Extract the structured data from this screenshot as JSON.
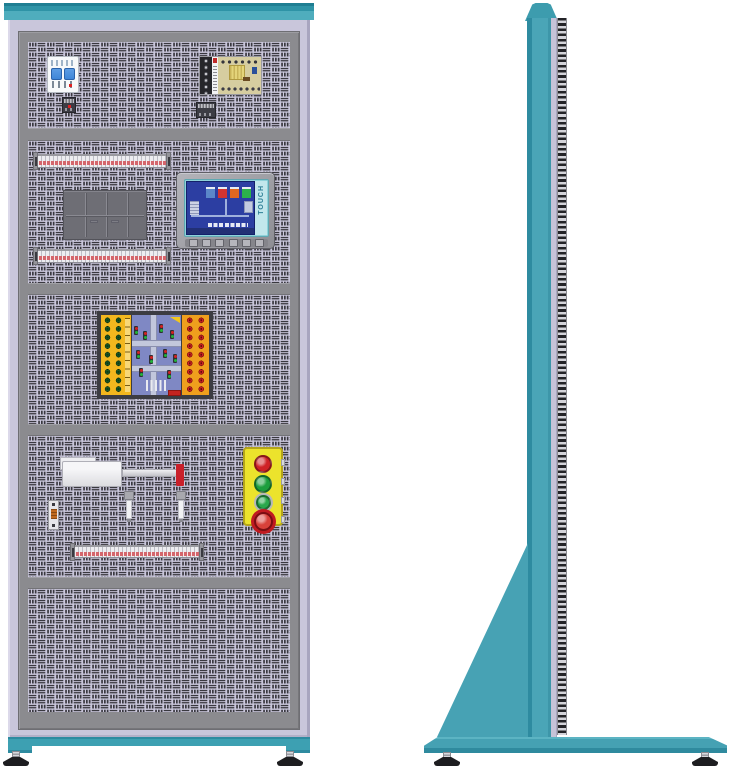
{
  "title": "Electrical automation training cabinet — front view and side view",
  "colors": {
    "cabinet_teal": "#4aa5b7",
    "cabinet_teal_dark": "#2e8ba0",
    "frame_lavender": "#c9c6db",
    "panel_gray": "#8b8b8f",
    "perforation_dark": "#39383f",
    "station_yellow": "#ece32c",
    "board_yellow": "#f3b71e",
    "board_orange": "#ef9f1d",
    "board_blue": "#7f88c4",
    "hmi_screen_blue": "#2c3ea2",
    "terminal_strip_red": "#d4666c",
    "breaker_toggle_blue": "#3f86d8",
    "cylinder_tip_red": "#c9202a"
  },
  "hmi": {
    "touch_label": "TOUCH",
    "function_key_count": 6,
    "screen_indicators": [
      "#5b87c9",
      "#d23430",
      "#e0671f",
      "#2cb24b"
    ]
  },
  "pushbutton_station": {
    "buttons": [
      {
        "type": "red-pushbutton",
        "color": "#cf2127",
        "y": 6,
        "size": 18
      },
      {
        "type": "green-pushbutton",
        "color": "#1d9e3e",
        "y": 26,
        "size": 18
      },
      {
        "type": "green-pushbutton-small",
        "color": "#2aa84c",
        "y": 46,
        "size": 15
      },
      {
        "type": "emergency-stop-button",
        "color": "#d8413a",
        "y": 63,
        "size": 19
      }
    ]
  },
  "traffic_board": {
    "left_sockets": {
      "rows": 9,
      "cols": 2,
      "color": "#1c5c28"
    },
    "right_sockets": {
      "rows": 9,
      "cols": 2,
      "color": "#cf2222"
    },
    "signals": [
      {
        "x": 134,
        "y": 326
      },
      {
        "x": 143,
        "y": 331
      },
      {
        "x": 159,
        "y": 324
      },
      {
        "x": 170,
        "y": 330
      },
      {
        "x": 136,
        "y": 350
      },
      {
        "x": 149,
        "y": 355
      },
      {
        "x": 163,
        "y": 349
      },
      {
        "x": 173,
        "y": 354
      },
      {
        "x": 139,
        "y": 368
      },
      {
        "x": 167,
        "y": 370
      }
    ]
  },
  "components": {
    "front": [
      "circuit-breaker",
      "power-supply",
      "terminal-strip",
      "plc-module-block",
      "hmi-touch-panel",
      "terminal-strip",
      "traffic-light-training-board",
      "pneumatic-cylinder",
      "proximity-sensors",
      "relay-module",
      "pushbutton-station",
      "terminal-strip"
    ],
    "side": [
      "support-column",
      "mounting-slot-rail",
      "gusset-plate",
      "base-plate",
      "leveling-feet"
    ]
  }
}
